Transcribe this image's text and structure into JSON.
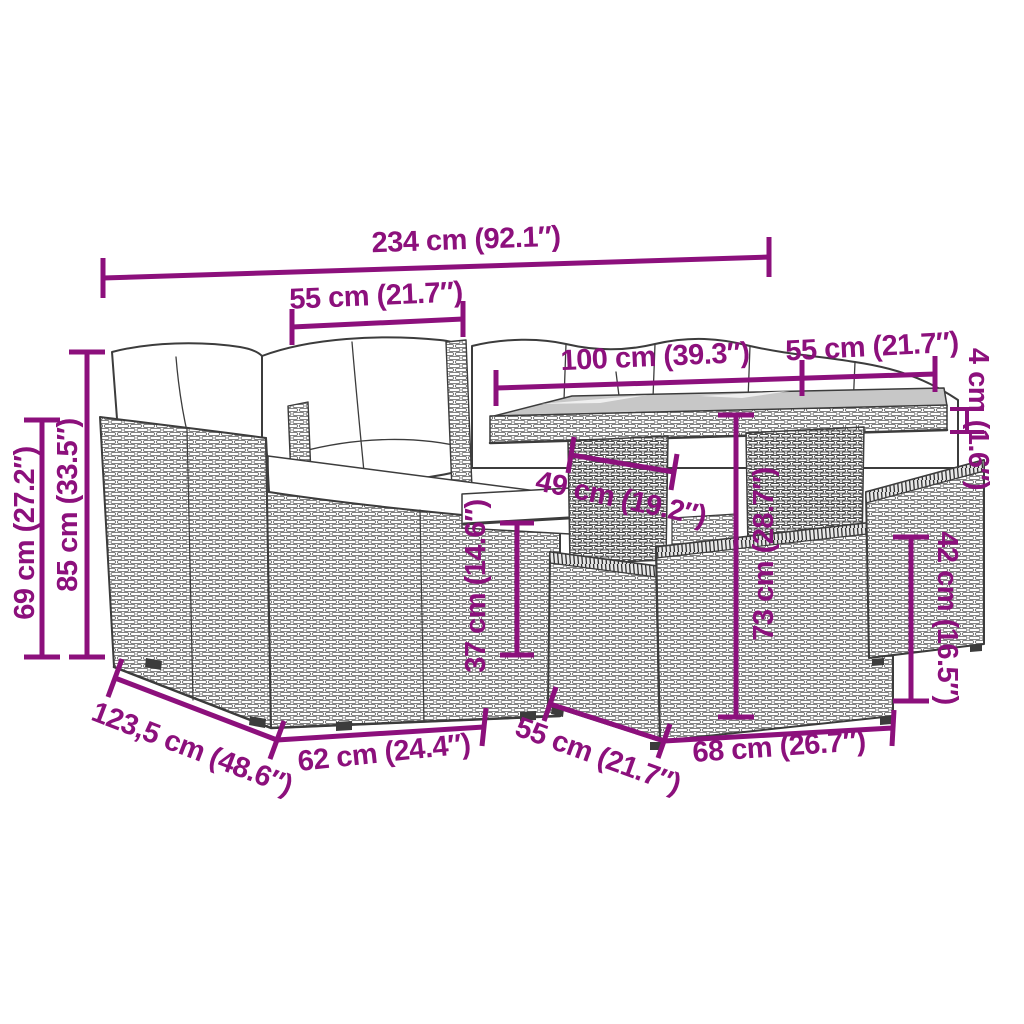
{
  "diagram": {
    "accent_color": "#8c107c",
    "line_color": "#3c3c3c",
    "glass_color": "#c7c7c7",
    "background_color": "#ffffff",
    "dimensions": {
      "width_total": {
        "label": "234 cm (92.1″)",
        "cm": 234,
        "inches": 92.1
      },
      "width_seat": {
        "label": "55 cm (21.7″)",
        "cm": 55,
        "inches": 21.7
      },
      "table_length": {
        "label": "100 cm (39.3″)",
        "cm": 100,
        "inches": 39.3
      },
      "table_depth": {
        "label": "55 cm (21.7″)",
        "cm": 55,
        "inches": 21.7
      },
      "table_top_thickness": {
        "label": "4 cm (1.6″)",
        "cm": 4,
        "inches": 1.6
      },
      "height_arm": {
        "label": "69 cm (27.2″)",
        "cm": 69,
        "inches": 27.2
      },
      "height_total": {
        "label": "85 cm (33.5″)",
        "cm": 85,
        "inches": 33.5
      },
      "stool_depth": {
        "label": "49 cm (19.2″)",
        "cm": 49,
        "inches": 19.2
      },
      "stool_height": {
        "label": "37 cm (14.6″)",
        "cm": 37,
        "inches": 14.6
      },
      "table_height": {
        "label": "73 cm (28.7″)",
        "cm": 73,
        "inches": 28.7
      },
      "right_stool_height": {
        "label": "42 cm (16.5″)",
        "cm": 42,
        "inches": 16.5
      },
      "depth_total": {
        "label": "123,5 cm (48.6″)",
        "cm": 123.5,
        "inches": 48.6
      },
      "depth_sofa": {
        "label": "62 cm (24.4″)",
        "cm": 62,
        "inches": 24.4
      },
      "stool_width": {
        "label": "55 cm (21.7″)",
        "cm": 55,
        "inches": 21.7
      },
      "stool_length": {
        "label": "68 cm (26.7″)",
        "cm": 68,
        "inches": 26.7
      }
    }
  }
}
